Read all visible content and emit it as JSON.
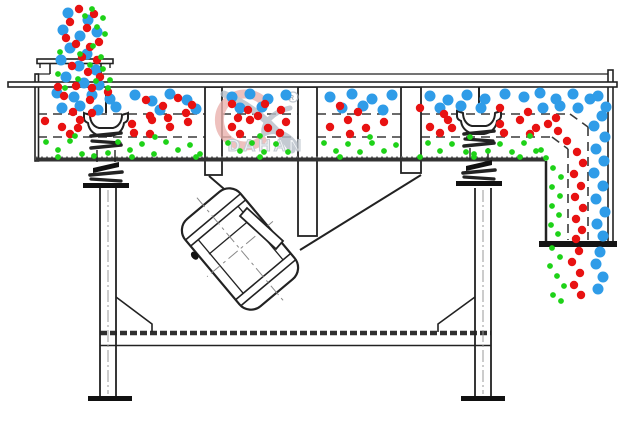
{
  "watermark": {
    "brand": "DAHAN",
    "registered_mark": "R"
  },
  "colors": {
    "coarse_blue": "#2f9ce8",
    "medium_red": "#e81212",
    "fine_green": "#1ed218",
    "line_dark": "#222222",
    "watermark_red": "#eab2ae",
    "watermark_gray": "#b6bec8"
  },
  "particles": {
    "radius": {
      "blue": 5.5,
      "red": 4.2,
      "green": 2.9
    },
    "groups": [
      {
        "name": "feed-stream-blue",
        "color": "blue",
        "points": [
          [
            68,
            13
          ],
          [
            88,
            20
          ],
          [
            63,
            30
          ],
          [
            80,
            36
          ],
          [
            97,
            32
          ],
          [
            70,
            48
          ],
          [
            87,
            54
          ],
          [
            61,
            60
          ],
          [
            79,
            66
          ],
          [
            96,
            70
          ],
          [
            66,
            77
          ],
          [
            84,
            83
          ],
          [
            99,
            85
          ],
          [
            57,
            93
          ],
          [
            74,
            97
          ],
          [
            92,
            95
          ],
          [
            110,
            99
          ],
          [
            62,
            108
          ],
          [
            80,
            106
          ],
          [
            98,
            110
          ],
          [
            116,
            107
          ]
        ]
      },
      {
        "name": "deck1-blue",
        "color": "blue",
        "points": [
          [
            135,
            95
          ],
          [
            152,
            101
          ],
          [
            170,
            94
          ],
          [
            187,
            100
          ],
          [
            160,
            110
          ],
          [
            196,
            109
          ],
          [
            232,
            97
          ],
          [
            250,
            94
          ],
          [
            268,
            99
          ],
          [
            286,
            95
          ],
          [
            240,
            108
          ],
          [
            262,
            107
          ],
          [
            330,
            97
          ],
          [
            352,
            94
          ],
          [
            372,
            99
          ],
          [
            392,
            95
          ],
          [
            342,
            108
          ],
          [
            363,
            106
          ],
          [
            383,
            110
          ],
          [
            430,
            96
          ],
          [
            448,
            100
          ],
          [
            467,
            95
          ],
          [
            485,
            99
          ],
          [
            505,
            94
          ],
          [
            524,
            97
          ],
          [
            440,
            108
          ],
          [
            461,
            106
          ],
          [
            481,
            108
          ],
          [
            540,
            93
          ],
          [
            556,
            99
          ],
          [
            573,
            94
          ],
          [
            590,
            99
          ],
          [
            543,
            108
          ],
          [
            560,
            106
          ],
          [
            578,
            108
          ],
          [
            598,
            96
          ],
          [
            606,
            107
          ]
        ]
      },
      {
        "name": "overflow-blue",
        "color": "blue",
        "points": [
          [
            602,
            116
          ],
          [
            594,
            126
          ],
          [
            605,
            137
          ],
          [
            596,
            149
          ],
          [
            604,
            161
          ],
          [
            594,
            173
          ],
          [
            603,
            186
          ],
          [
            596,
            199
          ],
          [
            605,
            212
          ],
          [
            597,
            224
          ],
          [
            603,
            236
          ]
        ]
      },
      {
        "name": "outlet-blue",
        "color": "blue",
        "points": [
          [
            600,
            252
          ],
          [
            596,
            264
          ],
          [
            603,
            277
          ],
          [
            598,
            289
          ]
        ]
      },
      {
        "name": "feed-stream-red",
        "color": "red",
        "points": [
          [
            79,
            9
          ],
          [
            94,
            14
          ],
          [
            70,
            22
          ],
          [
            87,
            28
          ],
          [
            99,
            42
          ],
          [
            76,
            44
          ],
          [
            90,
            47
          ],
          [
            66,
            38
          ],
          [
            82,
            57
          ],
          [
            97,
            60
          ],
          [
            72,
            66
          ],
          [
            88,
            72
          ],
          [
            100,
            77
          ],
          [
            76,
            86
          ],
          [
            92,
            88
          ],
          [
            58,
            87
          ],
          [
            64,
            96
          ],
          [
            90,
            100
          ],
          [
            108,
            92
          ],
          [
            73,
            112
          ],
          [
            92,
            113
          ]
        ]
      },
      {
        "name": "deck1-fallthrough-red",
        "color": "red",
        "points": [
          [
            146,
            100
          ],
          [
            163,
            106
          ],
          [
            178,
            98
          ],
          [
            192,
            105
          ],
          [
            150,
            116
          ],
          [
            168,
            118
          ],
          [
            186,
            113
          ],
          [
            232,
            104
          ],
          [
            248,
            110
          ],
          [
            265,
            104
          ],
          [
            281,
            110
          ],
          [
            238,
            118
          ],
          [
            258,
            116
          ],
          [
            340,
            106
          ],
          [
            358,
            112
          ],
          [
            420,
            108
          ],
          [
            444,
            114
          ],
          [
            500,
            108
          ],
          [
            528,
            112
          ],
          [
            556,
            118
          ]
        ]
      },
      {
        "name": "deck2-red",
        "color": "red",
        "points": [
          [
            45,
            121
          ],
          [
            62,
            127
          ],
          [
            80,
            120
          ],
          [
            132,
            124
          ],
          [
            78,
            128
          ],
          [
            152,
            120
          ],
          [
            170,
            127
          ],
          [
            188,
            122
          ],
          [
            232,
            127
          ],
          [
            250,
            120
          ],
          [
            268,
            128
          ],
          [
            286,
            122
          ],
          [
            330,
            127
          ],
          [
            348,
            120
          ],
          [
            366,
            128
          ],
          [
            384,
            122
          ],
          [
            430,
            127
          ],
          [
            448,
            120
          ],
          [
            452,
            128
          ],
          [
            500,
            124
          ],
          [
            520,
            120
          ],
          [
            536,
            128
          ],
          [
            548,
            124
          ],
          [
            70,
            134
          ],
          [
            134,
            133
          ],
          [
            150,
            134
          ],
          [
            240,
            134
          ],
          [
            280,
            133
          ],
          [
            350,
            134
          ],
          [
            440,
            133
          ],
          [
            504,
            133
          ],
          [
            530,
            134
          ]
        ]
      },
      {
        "name": "chute-red",
        "color": "red",
        "points": [
          [
            558,
            131
          ],
          [
            567,
            141
          ],
          [
            577,
            152
          ],
          [
            583,
            163
          ],
          [
            574,
            174
          ],
          [
            581,
            186
          ],
          [
            575,
            197
          ],
          [
            583,
            208
          ],
          [
            576,
            219
          ],
          [
            582,
            230
          ],
          [
            576,
            239
          ]
        ]
      },
      {
        "name": "outlet-red",
        "color": "red",
        "points": [
          [
            579,
            251
          ],
          [
            572,
            262
          ],
          [
            580,
            273
          ],
          [
            574,
            285
          ],
          [
            581,
            295
          ]
        ]
      },
      {
        "name": "feed-stream-green",
        "color": "green",
        "points": [
          [
            92,
            9
          ],
          [
            103,
            18
          ],
          [
            97,
            27
          ],
          [
            85,
            16
          ],
          [
            105,
            34
          ],
          [
            93,
            46
          ],
          [
            80,
            54
          ],
          [
            101,
            57
          ],
          [
            90,
            65
          ],
          [
            103,
            69
          ],
          [
            78,
            79
          ],
          [
            96,
            81
          ],
          [
            60,
            52
          ],
          [
            58,
            74
          ],
          [
            108,
            88
          ],
          [
            65,
            88
          ],
          [
            110,
            80
          ]
        ]
      },
      {
        "name": "pan-green",
        "color": "green",
        "points": [
          [
            46,
            142
          ],
          [
            58,
            150
          ],
          [
            70,
            141
          ],
          [
            82,
            154
          ],
          [
            94,
            156
          ],
          [
            108,
            153
          ],
          [
            118,
            142
          ],
          [
            130,
            150
          ],
          [
            142,
            144
          ],
          [
            154,
            154
          ],
          [
            166,
            142
          ],
          [
            178,
            150
          ],
          [
            190,
            145
          ],
          [
            200,
            154
          ],
          [
            228,
            143
          ],
          [
            240,
            151
          ],
          [
            252,
            143
          ],
          [
            264,
            152
          ],
          [
            276,
            144
          ],
          [
            288,
            152
          ],
          [
            324,
            143
          ],
          [
            336,
            151
          ],
          [
            348,
            144
          ],
          [
            360,
            152
          ],
          [
            372,
            143
          ],
          [
            384,
            151
          ],
          [
            396,
            145
          ],
          [
            428,
            143
          ],
          [
            440,
            151
          ],
          [
            452,
            144
          ],
          [
            466,
            152
          ],
          [
            474,
            154
          ],
          [
            488,
            151
          ],
          [
            500,
            144
          ],
          [
            512,
            152
          ],
          [
            524,
            143
          ],
          [
            536,
            151
          ],
          [
            75,
            136
          ],
          [
            155,
            137
          ],
          [
            260,
            136
          ],
          [
            370,
            137
          ],
          [
            470,
            137
          ],
          [
            530,
            136
          ],
          [
            58,
            157
          ],
          [
            132,
            157
          ],
          [
            196,
            157
          ],
          [
            260,
            157
          ],
          [
            340,
            157
          ],
          [
            420,
            157
          ],
          [
            474,
            157
          ],
          [
            520,
            157
          ]
        ]
      },
      {
        "name": "chute-green",
        "color": "green",
        "points": [
          [
            541,
            150
          ],
          [
            546,
            158
          ],
          [
            553,
            168
          ],
          [
            561,
            177
          ],
          [
            552,
            187
          ],
          [
            560,
            196
          ],
          [
            552,
            206
          ],
          [
            559,
            215
          ],
          [
            551,
            225
          ],
          [
            558,
            234
          ]
        ]
      },
      {
        "name": "outlet-green",
        "color": "green",
        "points": [
          [
            552,
            248
          ],
          [
            560,
            257
          ],
          [
            550,
            266
          ],
          [
            557,
            276
          ],
          [
            564,
            286
          ],
          [
            553,
            295
          ],
          [
            561,
            301
          ]
        ]
      }
    ]
  }
}
